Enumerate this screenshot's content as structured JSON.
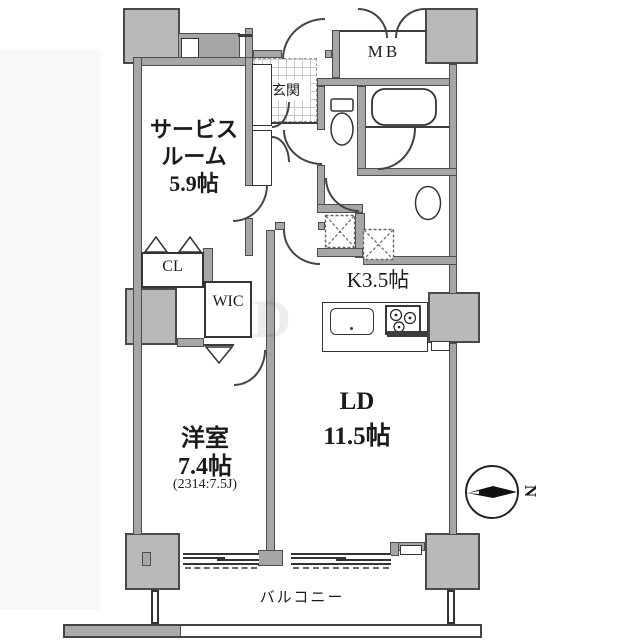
{
  "floorplan": {
    "rooms": {
      "service_room": {
        "label_line1": "サービス",
        "label_line2": "ルーム",
        "label_line3": "5.9帖"
      },
      "entrance": {
        "label": "玄関"
      },
      "meter_box": {
        "label": "MB"
      },
      "closet": {
        "label": "CL"
      },
      "walk_in_closet": {
        "label": "WIC"
      },
      "kitchen": {
        "label": "K3.5帖"
      },
      "living_dining": {
        "label_line1": "LD",
        "label_line2": "11.5帖"
      },
      "western_room": {
        "label_line1": "洋室",
        "label_line2": "7.4帖",
        "note": "(2314:7.5J)"
      },
      "balcony": {
        "label": "バルコニー"
      }
    },
    "compass": {
      "label": "N"
    },
    "watermark": {
      "label": "D"
    },
    "colors": {
      "wall": "#a6a6a6",
      "pillar": "#b9b9b9",
      "line": "#333333",
      "background": "#ffffff"
    }
  }
}
